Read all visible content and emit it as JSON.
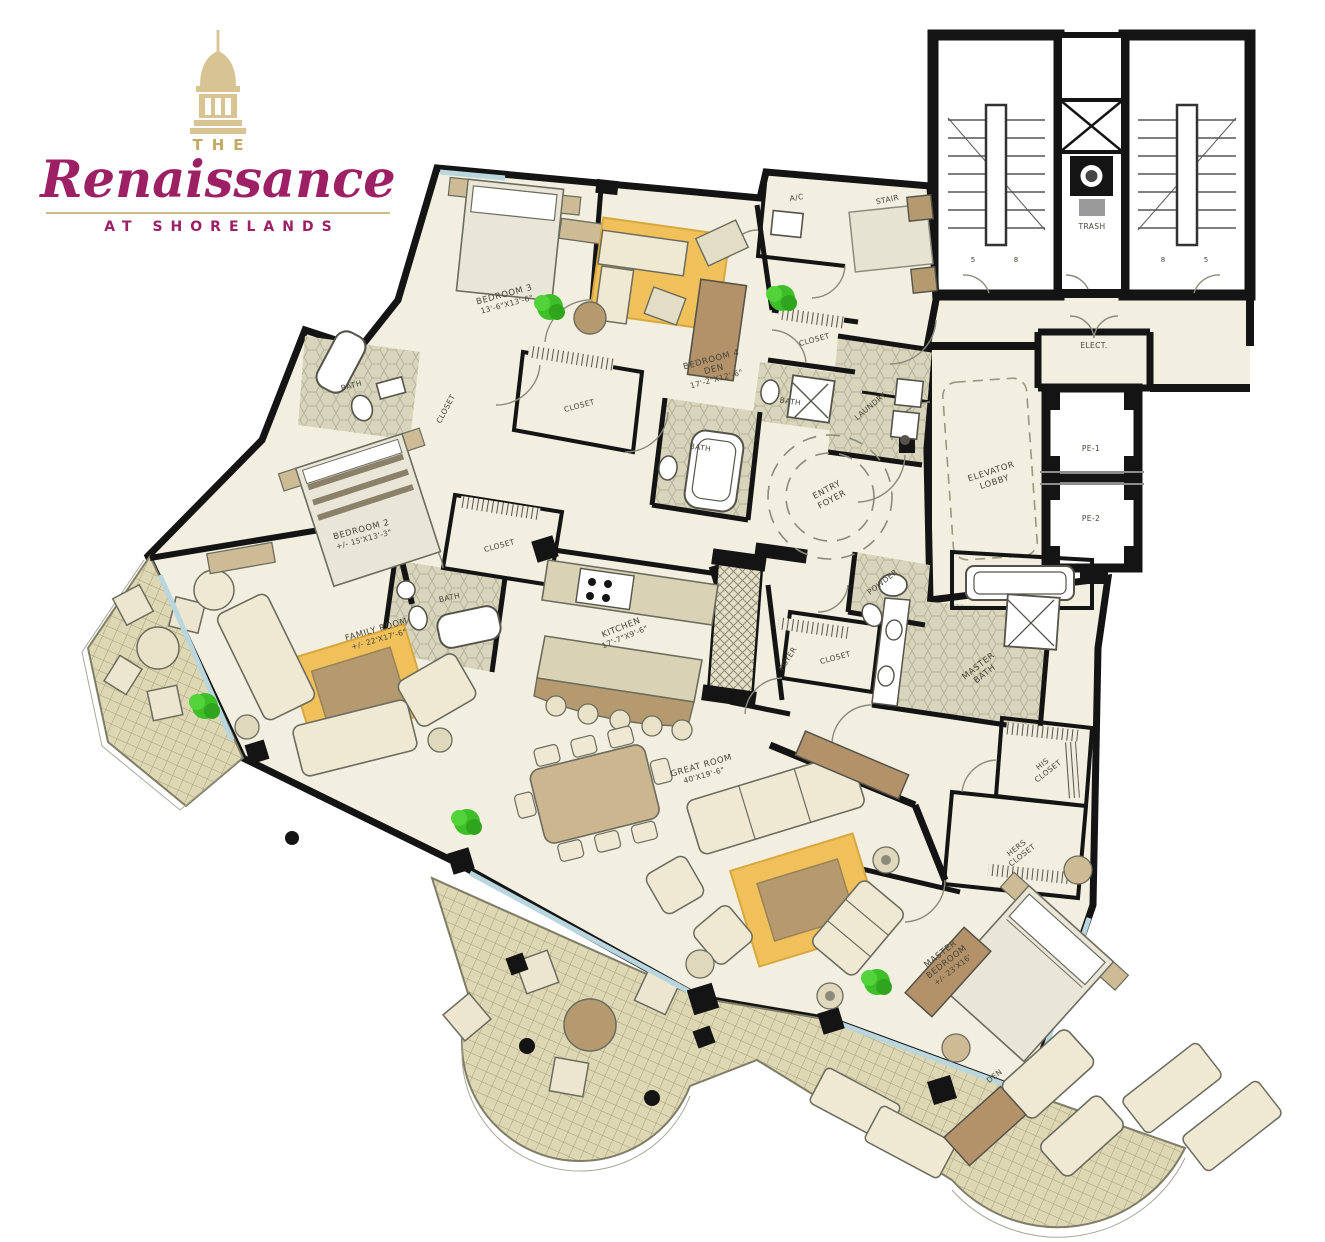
{
  "logo": {
    "the": "THE",
    "name": "Renaissance",
    "subtitle": "AT SHORELANDS"
  },
  "colors": {
    "brand_magenta": "#9c2063",
    "brand_gold": "#d8c492",
    "floor_cream": "#f2eee0",
    "terrace_tile": "#ded7b3",
    "bath_tile": "#d8d5bc",
    "rug_orange": "#f0c05a",
    "tree_green": "#3ebe28",
    "window_blue": "#b9d6de",
    "wall_black": "#141414"
  },
  "labels": {
    "bedroom3_name": "BEDROOM 3",
    "bedroom3_dims": "13'-6\"X13'-6\"",
    "bedroom4_name": "BEDROOM 4",
    "bedroom4_sub": "DEN",
    "bedroom4_dims": "17'-2\"X12'-6\"",
    "bedroom2_name": "BEDROOM 2",
    "bedroom2_dims": "+/- 15'X13'-3\"",
    "family_name": "FAMILY ROOM",
    "family_dims": "+/- 22'X17'-6\"",
    "kitchen_name": "KITCHEN",
    "kitchen_dims": "17'-7\"X9'-6\"",
    "great_name": "GREAT ROOM",
    "great_dims": "40'X19'-6\"",
    "master_l1": "MASTER",
    "master_l2": "BEDROOM",
    "master_dims": "+/- 23'X16'",
    "den": "DEN",
    "entry_l1": "ENTRY",
    "entry_l2": "FOYER",
    "foyer": "FOYER",
    "elevator_l1": "ELEVATOR",
    "elevator_l2": "LOBBY",
    "powder": "POWDER",
    "masterbath_l1": "MASTER",
    "masterbath_l2": "BATH",
    "his_l1": "HIS",
    "his_l2": "CLOSET",
    "hers_l1": "HERS",
    "hers_l2": "CLOSET",
    "laundry": "LAUNDRY",
    "stair": "STAIR",
    "ac": "A/C",
    "trash": "TRASH",
    "elect": "ELECT.",
    "pe1": "PE-1",
    "pe2": "PE-2",
    "bath": "BATH",
    "closet": "CLOSET",
    "num5": "5",
    "num8": "8"
  }
}
